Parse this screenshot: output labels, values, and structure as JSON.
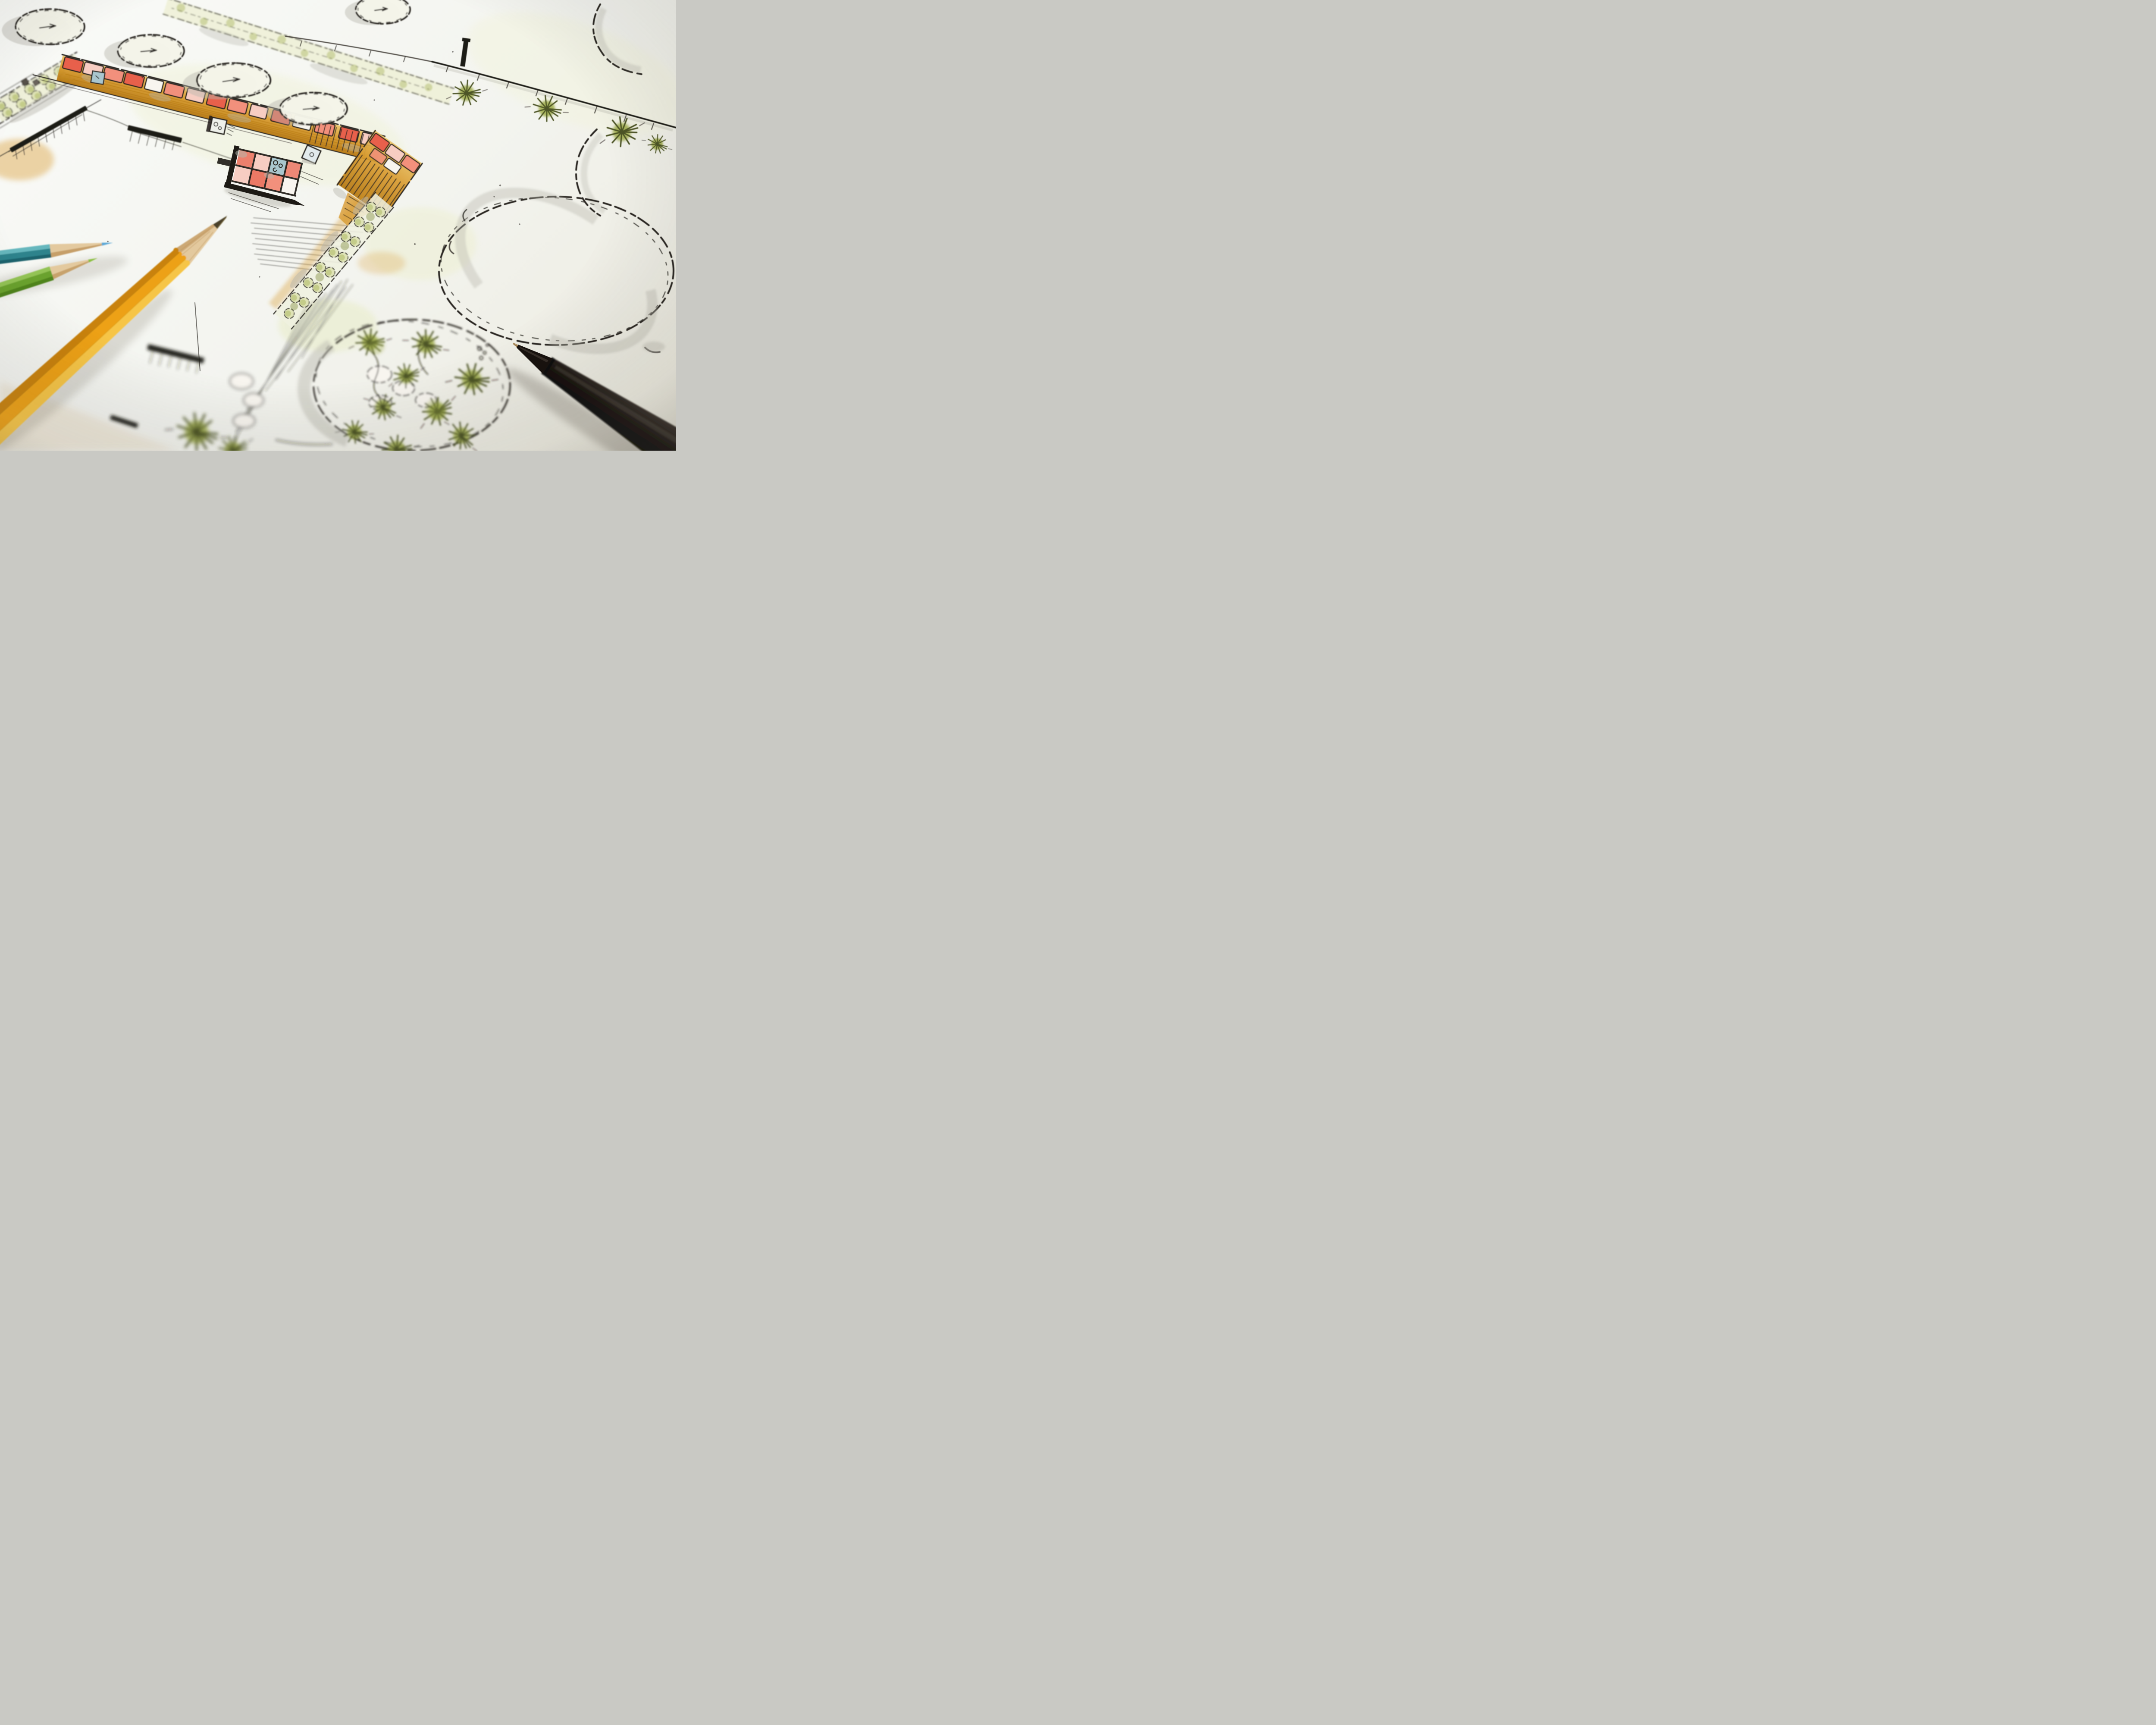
{
  "scene": {
    "description": "Close-up photograph of a hand-drawn landscape-architecture garden plan sketched in black ink with colored-pencil and marker rendering, photographed at an oblique angle with shallow depth of field",
    "paper": "white sketch paper, brightest at top right, soft defocus at the bottom and corners",
    "drawing_style": "loose freehand plan graphics: scalloped tree canopies with grey cast shadows, hedge bands of scalloped shrub balls, starburst shrub symbols, hatched ink walls, paver paths"
  },
  "plan": {
    "tree_symbols": {
      "count": 6,
      "style": "scalloped outline ellipse, small twig mark at centre, grey shadow crescent at lower left"
    },
    "large_canopies": {
      "count": 3,
      "style": "big squiggly ink outlines with grey marker band, right side of sheet"
    },
    "paths": {
      "main_path": "diagonal ochre band with coral-red pavers and ladder hatching, turning downward at its right end",
      "stepping_squares": [
        "blue-grey square",
        "square marked Co",
        "diamond marked o"
      ]
    },
    "paver_terrace": {
      "style": "grid of squares framed by heavy black ink wall",
      "cell_colors": [
        "red",
        "pale red",
        "white",
        "blue with oo marks"
      ]
    },
    "hedges": {
      "count": 3,
      "style": "bands of scalloped shrub balls tinted olive green"
    },
    "fence": {
      "position": "top right",
      "style": "dark rail with tick posts and three starburst shrubs"
    },
    "planting_bed": {
      "position": "bottom centre",
      "style": "large ellipse with starburst shrubs, stepping stones, dot cluster, radiating hatch lines"
    },
    "walls": "thick black ink bars with fine hatching, left and bottom left"
  },
  "tools": {
    "pencils": [
      {
        "name": "teal colored pencil",
        "body_hex": "#2e838c",
        "tip": "long sharpened wood cone with blue lead"
      },
      {
        "name": "green colored pencil",
        "body_hex": "#6aa22f",
        "tip": "green lead"
      },
      {
        "name": "yellow graphite pencil",
        "body_hex": "#eda117",
        "tip": "freshly sharpened, dark graphite point"
      }
    ],
    "pen": {
      "name": "black fineliner pen",
      "body_hex": "#17110d",
      "tip": "fine metal needle tip pointing upper left",
      "position": "bottom right, lying diagonally"
    }
  },
  "colors": {
    "paper-hi": "#fafbf8",
    "paper-mid": "#f3f4ef",
    "paper-lo": "#eceade",
    "ink": "#2a2722",
    "ink-heavy": "#1d1a15",
    "shadow": "#b7b6ac",
    "ochre": "#d89a2e",
    "ochre-deep": "#b5770f",
    "ochre-pale": "#ecc468",
    "paver-red": "#e8614b",
    "paver-light": "#f2907c",
    "paver-pale": "#f7cdc2",
    "stone-white": "#f8f5ef",
    "blue-stone": "#a9c6ce",
    "blue-soft": "#bfd6da",
    "hedge-green": "#a3b052",
    "hedge-light": "#dfe3b6",
    "hedge-pale": "#eef0d6",
    "hedge-olive": "#77842f",
    "spr-green": "#97a63e",
    "ink-green": "#4d5526",
    "tree-fill": "#f5f5e9",
    "tree-shadow": "#c5c4ba",
    "pencil-yellow": "#eda117",
    "pencil-yellow-hi": "#f6c547",
    "pencil-yellow-lo": "#c9820b",
    "pencil-green": "#6aa22f",
    "pencil-green-hi": "#93c355",
    "pencil-green-lo": "#4f841c",
    "pencil-teal": "#2e838c",
    "pencil-teal-hi": "#66b7bd",
    "pencil-teal-lo": "#1d646d",
    "lead-blue": "#5aa7d6",
    "lead-green": "#8abf3f",
    "lead-dark": "#4a4129",
    "wood-light": "#e3c99e",
    "wood-dark": "#b98d52",
    "pen-black": "#17110d",
    "pen-hi": "#4e463e",
    "pen-metal": "#a08050"
  }
}
